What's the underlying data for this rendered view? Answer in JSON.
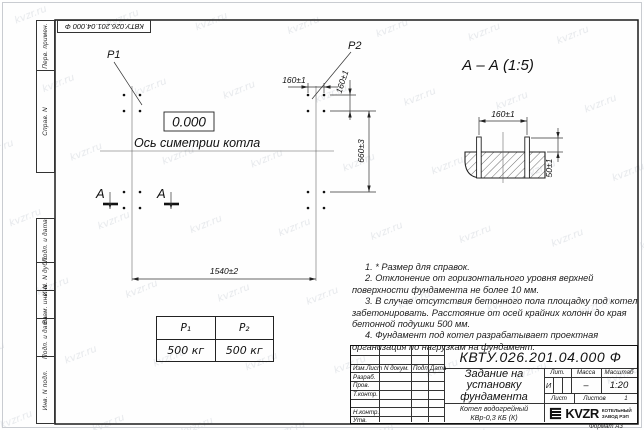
{
  "watermark": {
    "text": "kvzr.ru"
  },
  "margin": {
    "labels": [
      "Перв. примен.",
      "Справ. N",
      "Подп. и дата",
      "Инв. N дубл.",
      "Взам. инв. N",
      "Подп. и дата",
      "Инв. N подл."
    ]
  },
  "plan": {
    "p1": "P1",
    "p2": "P2",
    "level": "0.000",
    "axis_label": "Ось симетрии котла",
    "dim_bolt_h": "160±1",
    "dim_bolt_v": "160±1",
    "dim_660": "660±3",
    "dim_1540": "1540±2",
    "section_mark": "А"
  },
  "section": {
    "title": "А – А  (1:5)",
    "dim_160": "160±1",
    "dim_50": "50±1"
  },
  "load_table": {
    "p1_header": "P₁",
    "p2_header": "P₂",
    "p1_value": "500 кг",
    "p2_value": "500 кг"
  },
  "notes": [
    "1. * Размер для справок.",
    "2. Отклонение от горизонтального уровня верхней поверхности фундамента не более 10 мм.",
    "3. В случае отсутствия бетонного пола площадку под котел забетонировать. Расстояние от осей крайних колонн до края бетонной подушки 500 мм.",
    "4. Фундамент под котел разрабатывает проектная организация по нагрузкам на фундамент."
  ],
  "title_block": {
    "designation": "КВТУ.026.201.04.000  Ф",
    "doc_name": [
      "Задание на",
      "установку",
      "фундамента"
    ],
    "product": [
      "Котел водогрейный",
      "КВр-0,3 КБ  (К)"
    ],
    "columns": [
      "Изм.Лист",
      "N докум.",
      "Подп.",
      "Дата"
    ],
    "rows": [
      "Разраб.",
      "Пров.",
      "Т.контр.",
      "Н.контр.",
      "Утв."
    ],
    "lit_h": "Лит.",
    "mass_h": "Масса",
    "scale_h": "Масштаб",
    "lit": "И",
    "mass": "–",
    "scale": "1:20",
    "sheet_h": "Лист",
    "sheets_h": "Листов",
    "sheets": "1",
    "logo": {
      "name": "KVZR",
      "line1": "КОТЕЛЬНЫЙ",
      "line2": "ЗАВОД РЭП"
    },
    "format": "Формат А3"
  }
}
